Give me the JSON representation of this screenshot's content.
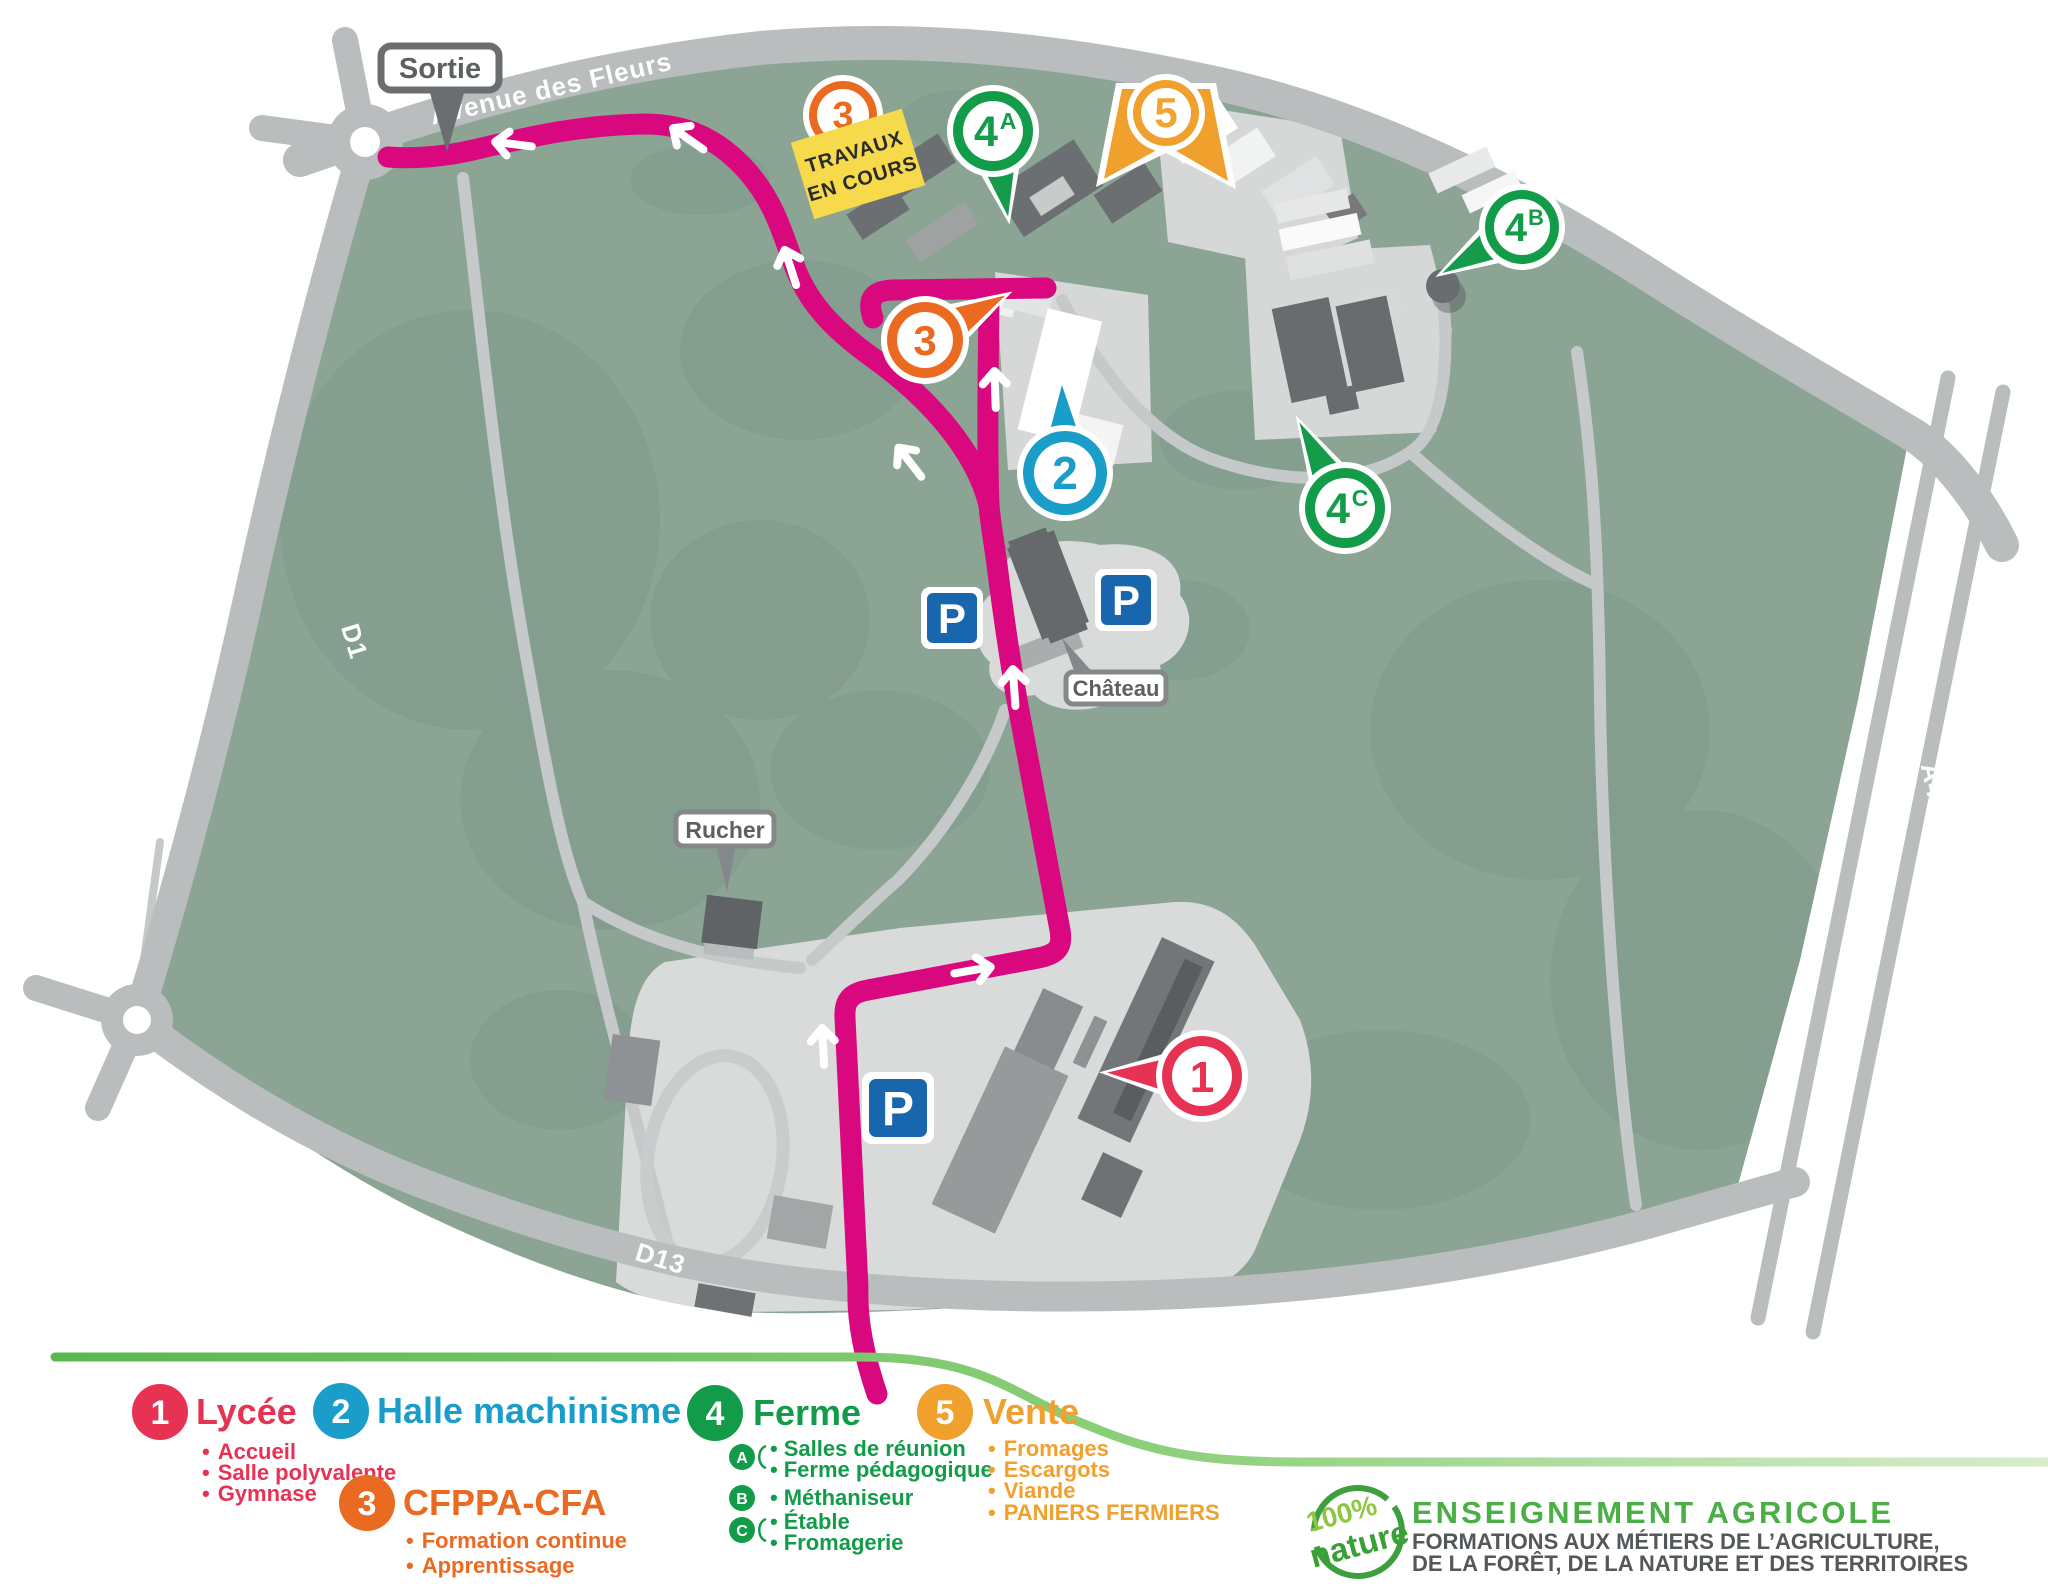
{
  "map": {
    "road_labels": {
      "avenue": "Avenue des Fleurs",
      "d1": "D1",
      "d13": "D13",
      "a43": "A43"
    },
    "callouts": {
      "sortie": "Sortie",
      "chateau": "Château",
      "rucher": "Rucher"
    },
    "construction_sign": {
      "line1": "TRAVAUX",
      "line2": "EN COURS"
    },
    "parking_label": "P",
    "pins": {
      "p1": {
        "number": "1"
      },
      "p2": {
        "number": "2"
      },
      "p3_map": {
        "number": "3"
      },
      "p3_top": {
        "number": "3"
      },
      "p4a": {
        "number": "4",
        "letter": "A"
      },
      "p4b": {
        "number": "4",
        "letter": "B"
      },
      "p4c": {
        "number": "4",
        "letter": "C"
      },
      "p5": {
        "number": "5"
      }
    },
    "colors": {
      "campus_green": "#8ca494",
      "tree_green": "#7e998b",
      "road_gray": "#babdbe",
      "route_pink": "#d9087e",
      "parking_blue": "#1766ae",
      "sign_yellow": "#f7d94c"
    }
  },
  "legend": {
    "items": [
      {
        "number": "1",
        "label": "Lycée",
        "color": "#e73253",
        "bullets": [
          "Accueil",
          "Salle polyvalente",
          "Gymnase"
        ]
      },
      {
        "number": "2",
        "label": "Halle machinisme",
        "color": "#1b9dc9",
        "bullets": []
      },
      {
        "number": "3",
        "label": "CFPPA-CFA",
        "color": "#eb6a22",
        "bullets": [
          "Formation continue",
          "Apprentissage"
        ]
      },
      {
        "number": "4",
        "label": "Ferme",
        "color": "#129c49",
        "sub": [
          {
            "letter": "A",
            "lines": [
              "Salles de réunion",
              "Ferme pédagogique"
            ]
          },
          {
            "letter": "B",
            "lines": [
              "Méthaniseur"
            ]
          },
          {
            "letter": "C",
            "lines": [
              "Étable",
              "Fromagerie"
            ]
          }
        ]
      },
      {
        "number": "5",
        "label": "Vente",
        "color": "#f0a02c",
        "bullets": [
          "Fromages",
          "Escargots",
          "Viande",
          "PANIERS FERMIERS"
        ]
      }
    ]
  },
  "branding": {
    "badge_top": "100%",
    "badge_bottom": "nature",
    "title": "ENSEIGNEMENT AGRICOLE",
    "subtitle1": "FORMATIONS AUX MÉTIERS DE L’AGRICULTURE,",
    "subtitle2": "DE LA FORÊT, DE LA NATURE ET DES TERRITOIRES"
  }
}
